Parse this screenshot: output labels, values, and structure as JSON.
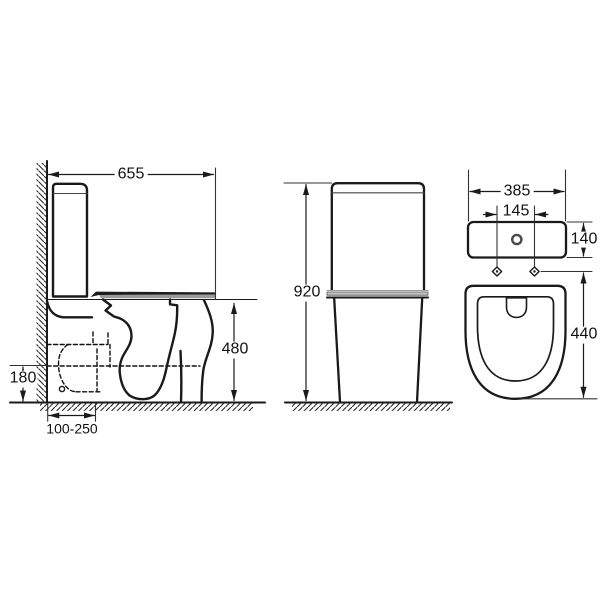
{
  "dimensions": {
    "side_view": {
      "overall_depth": "655",
      "seat_height": "480",
      "outlet_height": "180",
      "outlet_setout": "100-250"
    },
    "back_view": {
      "overall_height": "920"
    },
    "front_view": {
      "overall_width": "385",
      "fixing_centres": "145",
      "cistern_height": "140",
      "pan_height": "440"
    }
  },
  "colors": {
    "line": "#1a1a1a",
    "background": "#ffffff",
    "seat_shading": "#9a9a9a"
  }
}
